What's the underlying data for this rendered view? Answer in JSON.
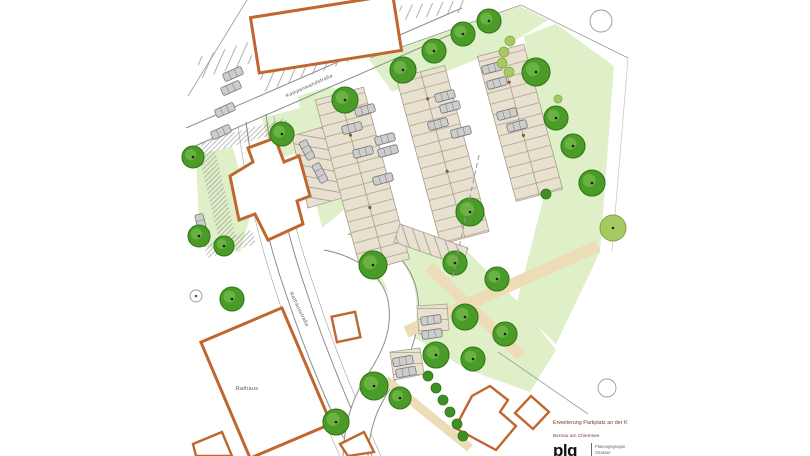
{
  "title_block": {
    "line1": "Erweiterung Parkplatz an der K",
    "line2": "Bernau am Chiemsee",
    "logo": "plg",
    "firm_line1": "Planungsgruppe",
    "firm_line2": "Strasser"
  },
  "labels": {
    "street_top": "Kampenwandstraße",
    "street_left": "Rathausstraße",
    "rathaus": "Rathaus"
  },
  "colors": {
    "building_outline": "#c0662f",
    "stall": "#e9e1cf",
    "stall_line": "#a89f8c",
    "lawn": "#dff0c8",
    "path": "#ecdcb7",
    "tree_fill": "#4a9b28",
    "tree_dark": "#2f7714",
    "tree_hi": "#76b94e",
    "tree_light": "#a6c964",
    "bush": "#3f8f24",
    "car": "#cdcdcd",
    "car_line": "#777777",
    "curb": "#8c8c8c",
    "text_gray": "#555555",
    "title_red": "#7c3f2c",
    "firm_gray": "#666666",
    "logo_black": "#111111"
  },
  "symbols": {
    "tree": "tree-symbol",
    "bush": "bush-symbol",
    "car": "car-symbol",
    "building": "building-outline",
    "manhole": "manhole-circle"
  },
  "features": {
    "trees_dark": [
      [
        403,
        70,
        13
      ],
      [
        434,
        51,
        12
      ],
      [
        463,
        34,
        12
      ],
      [
        489,
        21,
        12
      ],
      [
        536,
        72,
        14
      ],
      [
        556,
        118,
        12
      ],
      [
        573,
        146,
        12
      ],
      [
        592,
        183,
        13
      ],
      [
        345,
        100,
        13
      ],
      [
        282,
        134,
        12
      ],
      [
        193,
        157,
        11
      ],
      [
        199,
        236,
        11
      ],
      [
        224,
        246,
        10
      ],
      [
        232,
        299,
        12
      ],
      [
        470,
        212,
        14
      ],
      [
        455,
        263,
        12
      ],
      [
        373,
        265,
        14
      ],
      [
        497,
        279,
        12
      ],
      [
        465,
        317,
        13
      ],
      [
        505,
        334,
        12
      ],
      [
        436,
        355,
        13
      ],
      [
        473,
        359,
        12
      ],
      [
        374,
        386,
        14
      ],
      [
        400,
        398,
        11
      ],
      [
        336,
        422,
        13
      ]
    ],
    "trees_light": [
      [
        613,
        228,
        13
      ]
    ],
    "bushes_dark": [
      [
        428,
        376,
        5
      ],
      [
        436,
        388,
        5
      ],
      [
        443,
        400,
        5
      ],
      [
        450,
        412,
        5
      ],
      [
        457,
        424,
        5
      ],
      [
        463,
        436,
        5
      ],
      [
        546,
        194,
        5
      ]
    ],
    "bushes_light": [
      [
        510,
        41,
        5
      ],
      [
        504,
        52,
        5
      ],
      [
        502,
        63,
        5
      ],
      [
        509,
        72,
        5
      ],
      [
        558,
        99,
        4
      ]
    ],
    "cars": [
      [
        365,
        110,
        -15
      ],
      [
        352,
        128,
        -15
      ],
      [
        385,
        139,
        -15
      ],
      [
        363,
        152,
        -15
      ],
      [
        388,
        151,
        -15
      ],
      [
        383,
        179,
        -15
      ],
      [
        445,
        96,
        -15
      ],
      [
        450,
        107,
        -15
      ],
      [
        438,
        124,
        -15
      ],
      [
        461,
        132,
        -15
      ],
      [
        492,
        68,
        -15
      ],
      [
        497,
        83,
        -15
      ],
      [
        507,
        114,
        -15
      ],
      [
        517,
        126,
        -15
      ],
      [
        431,
        320,
        -8
      ],
      [
        432,
        334,
        -8
      ],
      [
        403,
        361,
        -10
      ],
      [
        406,
        372,
        -10
      ],
      [
        233,
        74,
        -24
      ],
      [
        231,
        88,
        -24
      ],
      [
        225,
        110,
        -24
      ],
      [
        221,
        132,
        -24
      ],
      [
        201,
        224,
        77
      ],
      [
        307,
        150,
        62
      ],
      [
        320,
        173,
        62
      ]
    ]
  }
}
